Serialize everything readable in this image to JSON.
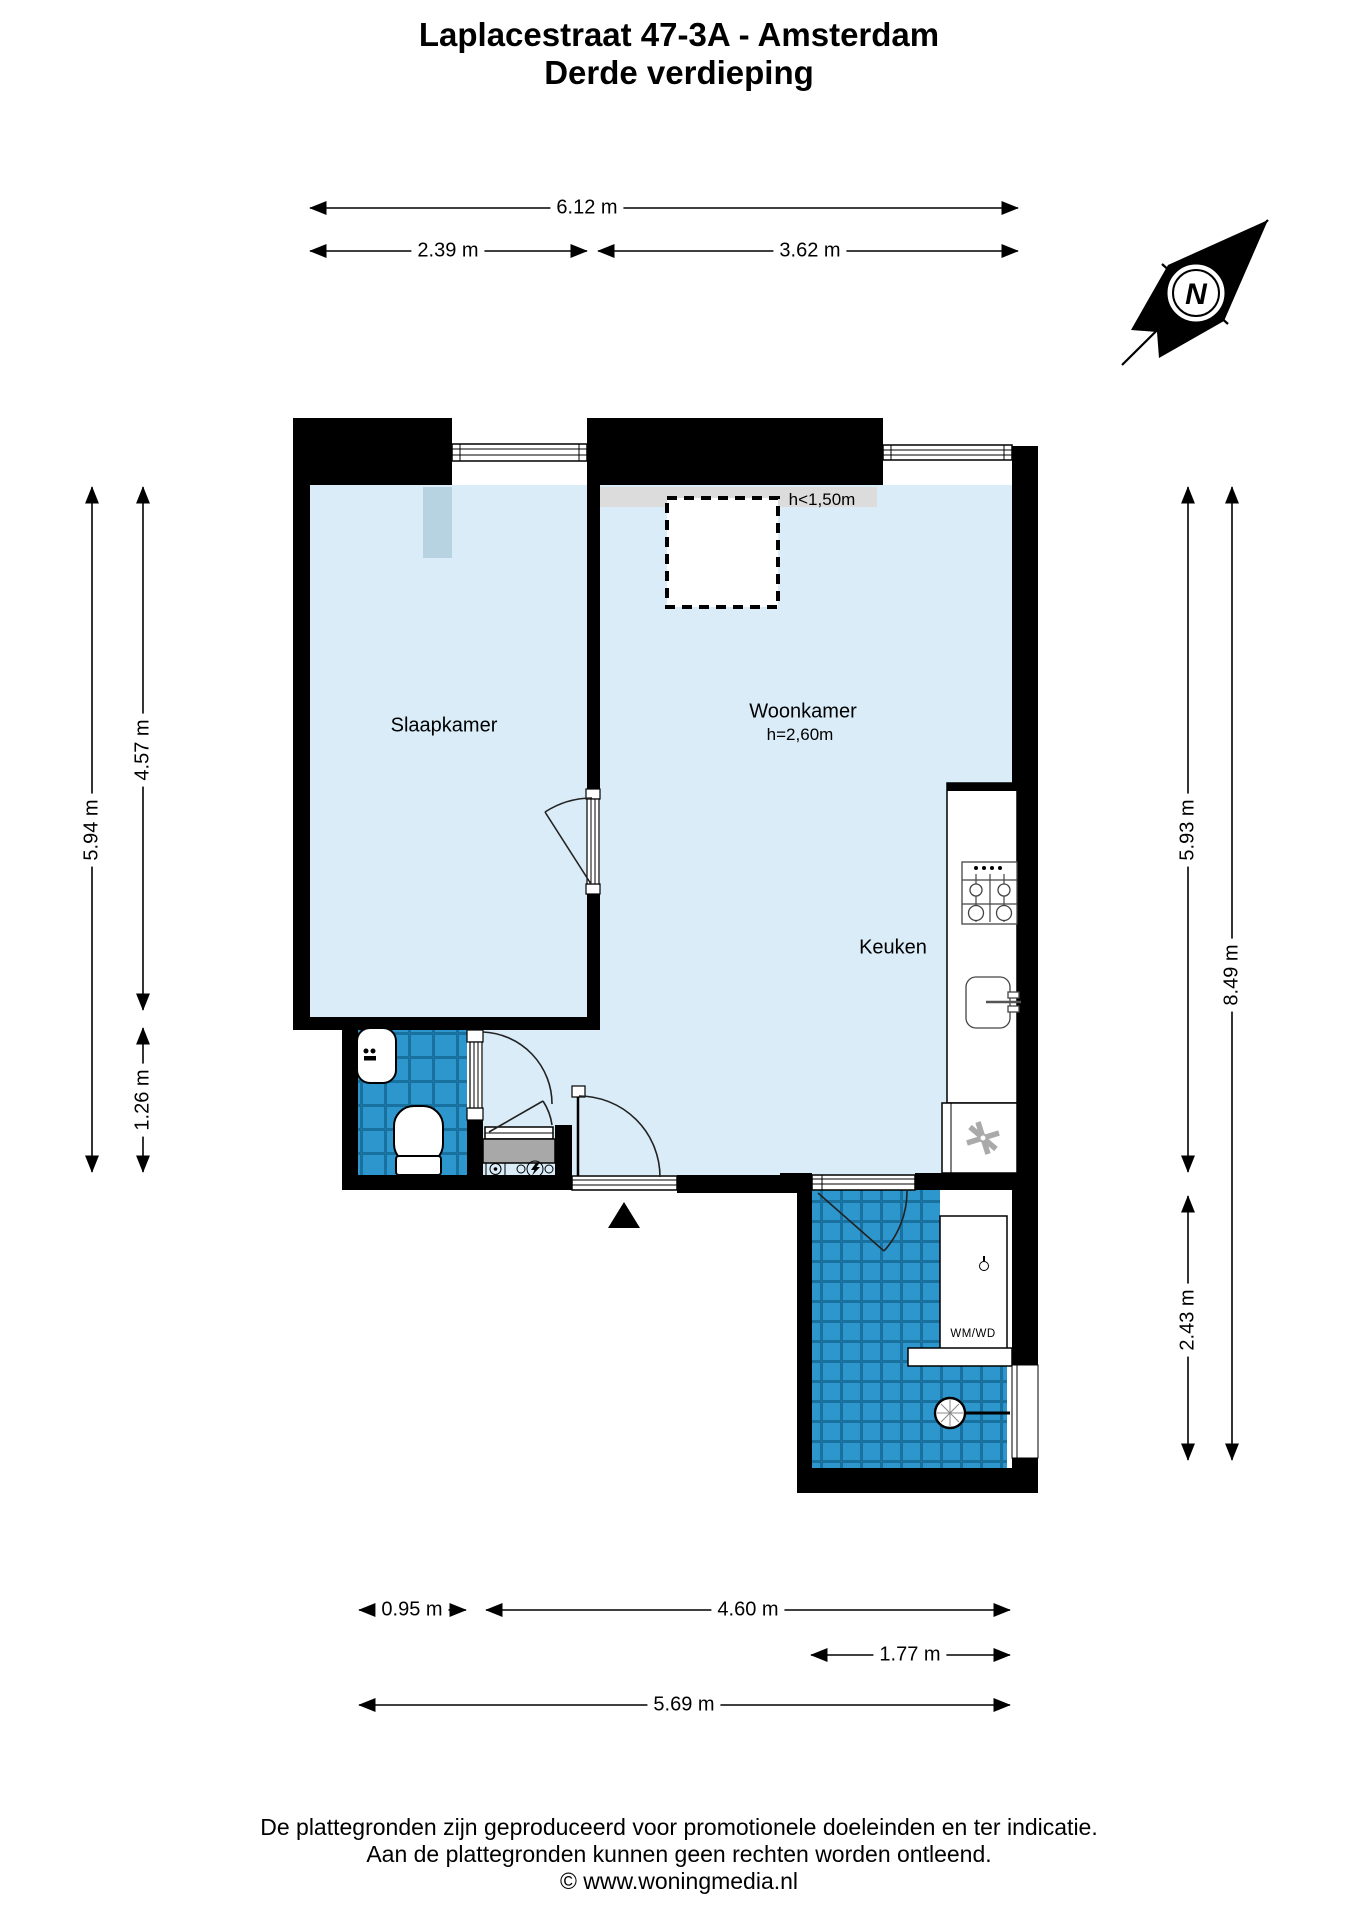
{
  "title": {
    "line1": "Laplacestraat 47-3A - Amsterdam",
    "line2": "Derde verdieping"
  },
  "compass": {
    "letter": "N"
  },
  "rooms": {
    "slaapkamer": "Slaapkamer",
    "woonkamer": "Woonkamer",
    "woonkamer_height": "h=2,60m",
    "keuken": "Keuken",
    "low_height_zone": "h<1,50m",
    "washer": "WM/WD"
  },
  "dimensions": {
    "top_total": "6.12 m",
    "top_left": "2.39 m",
    "top_right": "3.62 m",
    "left_total": "5.94 m",
    "left_upper": "4.57 m",
    "left_lower": "1.26 m",
    "right_upper": "5.93 m",
    "right_total": "8.49 m",
    "right_lower": "2.43 m",
    "bottom_bath": "0.95 m",
    "bottom_mid": "4.60 m",
    "bottom_laundry": "1.77 m",
    "bottom_total": "5.69 m"
  },
  "footer": {
    "line1": "De plattegronden zijn geproduceerd voor promotionele doeleinden en ter indicatie.",
    "line2": "Aan de plattegronden kunnen geen rechten worden ontleend.",
    "line3": "© www.woningmedia.nl"
  },
  "colors": {
    "wall": "#000000",
    "floor": "#d9ecf7",
    "low_height_band": "#dcdcdc",
    "chimney": "#b7d3e2",
    "tile_blue": "#2d96cd",
    "tile_grout": "#19719f",
    "meter_cabinet_gray": "#a8a8a8"
  }
}
